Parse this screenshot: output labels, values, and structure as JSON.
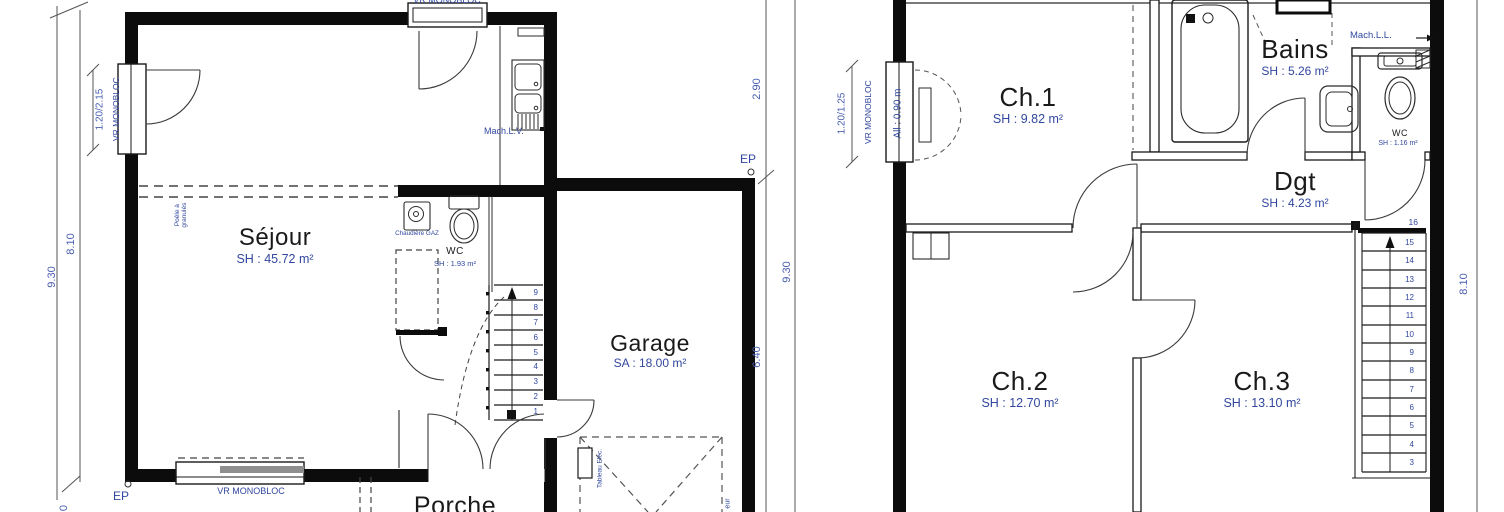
{
  "drawing": {
    "type": "floor-plans",
    "sheets": [
      "rez-de-chaussée",
      "étage"
    ]
  },
  "colors": {
    "wall": "#000000",
    "line": "#2b2b2b",
    "annotation": "#31479e",
    "dimension": "#4a5fb0",
    "ink": "#1a1a1a"
  },
  "ground_floor": {
    "rooms": {
      "sejour": {
        "name": "Séjour",
        "area": "SH : 45.72 m²"
      },
      "wc": {
        "name": "WC",
        "area": "SH : 1.93 m²"
      },
      "garage": {
        "name": "Garage",
        "area": "SA : 18.00 m²"
      },
      "porche": {
        "name": "Porche"
      }
    },
    "annotations": {
      "vr_monobloc_top": "VR MONOBLOC",
      "vr_monobloc_left": "VR MONOBLOC",
      "vr_monobloc_bottom": "VR MONOBLOC",
      "window_left_size": "1.20/2.15",
      "poele": "Poêle à granulés",
      "chaudiere": "Chaudière GAZ",
      "mach_lv": "Mach.L.V.",
      "tableau_elec": "Tableau Elec.",
      "garage_label_fragment": "eur",
      "ep_1": "EP",
      "ep_2": "EP"
    },
    "dimensions": {
      "left_outer": "9.30",
      "left_inner": "8.10",
      "right_top": "2.90",
      "right_bottom": "6.40",
      "right_outer": "9.30",
      "bottom_fragment": "0"
    },
    "stairs": {
      "steps": [
        "9",
        "8",
        "7",
        "6",
        "5",
        "4",
        "3",
        "2",
        "1"
      ]
    }
  },
  "first_floor": {
    "rooms": {
      "ch1": {
        "name": "Ch.1",
        "area": "SH : 9.82 m²"
      },
      "bains": {
        "name": "Bains",
        "area": "SH : 5.26 m²"
      },
      "wc": {
        "name": "WC",
        "area": "SH : 1.16 m²"
      },
      "dgt": {
        "name": "Dgt",
        "area": "SH : 4.23 m²"
      },
      "ch2": {
        "name": "Ch.2",
        "area": "SH : 12.70 m²"
      },
      "ch3": {
        "name": "Ch.3",
        "area": "SH : 13.10 m²"
      }
    },
    "annotations": {
      "vr_monobloc": "VR MONOBLOC",
      "window_size": "1.20/1.25",
      "allege": "All : 0.90 m",
      "mach_ll": "Mach.L.L."
    },
    "dimensions": {
      "right": "8.10"
    },
    "stairs": {
      "top_partial": "16",
      "steps": [
        "15",
        "14",
        "13",
        "12",
        "11",
        "10",
        "9",
        "8",
        "7",
        "6",
        "5",
        "4",
        "3"
      ]
    }
  }
}
